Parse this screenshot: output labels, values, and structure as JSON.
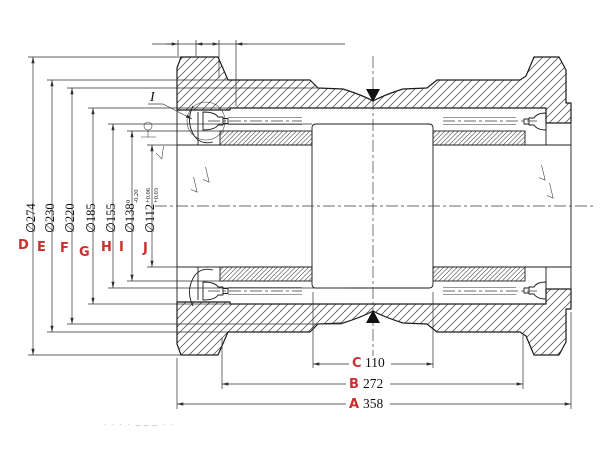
{
  "drawing": {
    "detail_label": "I",
    "dims": {
      "D": {
        "letter": "D",
        "value": "∅274"
      },
      "E": {
        "letter": "E",
        "value": "∅230"
      },
      "F": {
        "letter": "F",
        "value": "∅220"
      },
      "G": {
        "letter": "G",
        "value": "∅185"
      },
      "H": {
        "letter": "H",
        "value": "∅155"
      },
      "I": {
        "letter": "I",
        "value": "∅138",
        "tol_top": "0",
        "tol_bot": "-0.20"
      },
      "J": {
        "letter": "J",
        "value": "∅112",
        "tol_top": "+0.06",
        "tol_bot": "+0.03"
      }
    },
    "lengths": {
      "C": {
        "letter": "C",
        "value": "110"
      },
      "B": {
        "letter": "B",
        "value": "272"
      },
      "A": {
        "letter": "A",
        "value": "358"
      }
    },
    "footer_marks": "· ·   · ·   ———   · ·",
    "colors": {
      "accent": "#c8302e",
      "line": "#1b1b1b"
    }
  }
}
